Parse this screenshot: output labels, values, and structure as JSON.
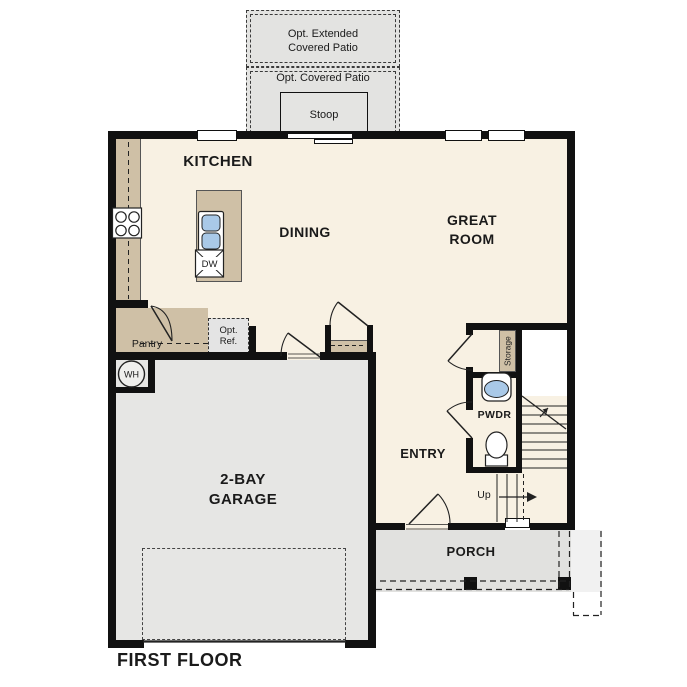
{
  "title": "FIRST FLOOR",
  "rooms": {
    "kitchen": "KITCHEN",
    "dining": "DINING",
    "great_room_line1": "GREAT",
    "great_room_line2": "ROOM",
    "garage_line1": "2-BAY",
    "garage_line2": "GARAGE",
    "entry": "ENTRY",
    "pwdr": "PWDR",
    "porch": "PORCH",
    "pantry": "Pantry",
    "storage": "Storage"
  },
  "optional_features": {
    "extended_patio_line1": "Opt. Extended",
    "extended_patio_line2": "Covered Patio",
    "covered_patio": "Opt. Covered Patio",
    "stoop": "Stoop",
    "ref_line1": "Opt.",
    "ref_line2": "Ref."
  },
  "fixtures": {
    "water_heater": "WH",
    "dishwasher": "DW",
    "stairs_direction": "Up"
  },
  "colors": {
    "floor": "#f8f1e3",
    "counter": "#cfc0a6",
    "garage": "#e6e6e4",
    "patio": "#e3e3e1",
    "stoop": "#e4e4e2",
    "porch": "#e1e1df",
    "optref": "#e4e4e4",
    "sink": "#a9c9e8",
    "wall": "#111111",
    "line": "#333333",
    "text": "#1a1a1a"
  }
}
